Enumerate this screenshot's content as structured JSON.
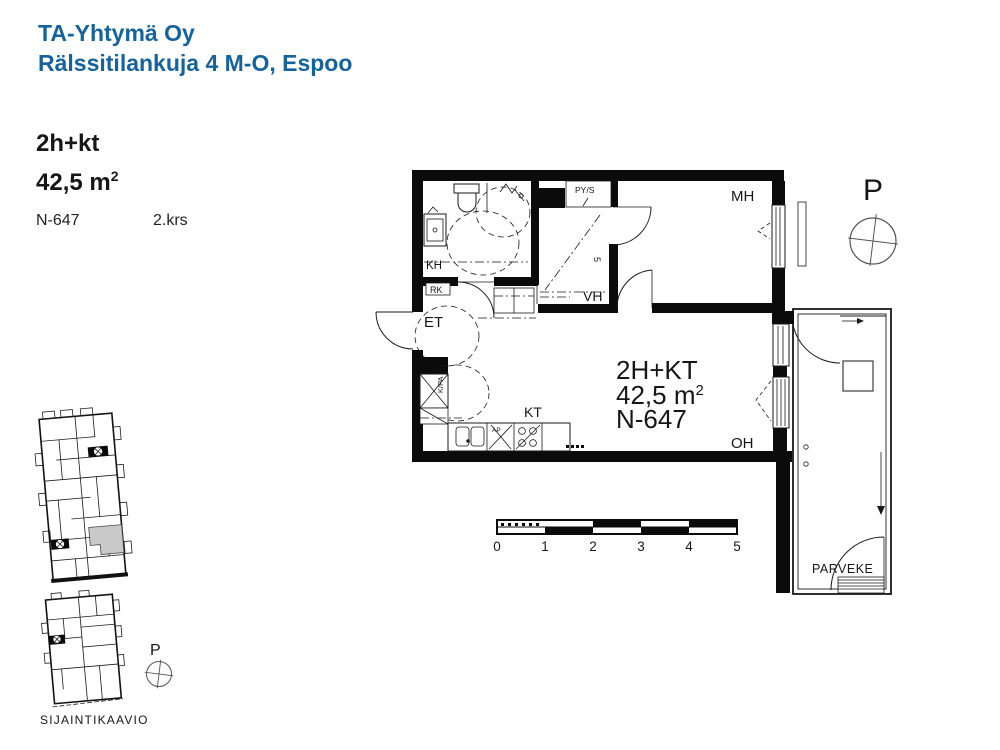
{
  "header": {
    "company": "TA-Yhtymä Oy",
    "address": "Rälssitilankuja 4 M-O, Espoo"
  },
  "apartment": {
    "type": "2h+kt",
    "area": "42,5 m",
    "area_sup": "2",
    "unit": "N-647",
    "floor": "2.krs"
  },
  "plan": {
    "info": {
      "line1": "2H+KT",
      "line2": "42,5 m",
      "line2_sup": "2",
      "line3": "N-647"
    },
    "rooms": {
      "kh": "KH",
      "rk": "RK",
      "et": "ET",
      "pys": "PY/S",
      "vh": "VH",
      "mh": "MH",
      "kt": "KT",
      "oh": "OH",
      "parveke": "PARVEKE",
      "kpa": "K/PA",
      "ap": "AP",
      "vh_mark": "5"
    },
    "compass": "P"
  },
  "scale_bar": {
    "ticks": [
      "0",
      "1",
      "2",
      "3",
      "4",
      "5"
    ]
  },
  "site": {
    "compass": "P",
    "caption": "SIJAINTIKAAVIO"
  },
  "colors": {
    "accent_blue": "#15639D",
    "line_black": "#0B0B0B",
    "unit_gray": "#C9C9C9",
    "compass_gray": "#555555"
  }
}
